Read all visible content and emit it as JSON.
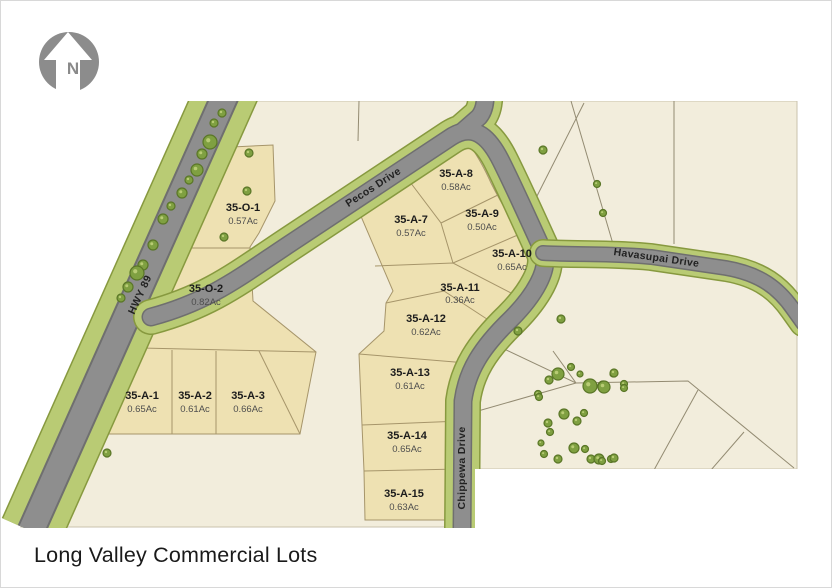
{
  "title": "Long Valley Commercial Lots",
  "north": {
    "label": "N"
  },
  "roads": [
    {
      "name": "HWY 89"
    },
    {
      "name": "Pecos Drive"
    },
    {
      "name": "Havasupai Drive"
    },
    {
      "name": "Chippewa Drive"
    }
  ],
  "lots": [
    {
      "id": "35-O-1",
      "acreage": "0.57Ac"
    },
    {
      "id": "35-O-2",
      "acreage": "0.82Ac"
    },
    {
      "id": "35-A-1",
      "acreage": "0.65Ac"
    },
    {
      "id": "35-A-2",
      "acreage": "0.61Ac"
    },
    {
      "id": "35-A-3",
      "acreage": "0.66Ac"
    },
    {
      "id": "35-A-7",
      "acreage": "0.57Ac"
    },
    {
      "id": "35-A-8",
      "acreage": "0.58Ac"
    },
    {
      "id": "35-A-9",
      "acreage": "0.50Ac"
    },
    {
      "id": "35-A-10",
      "acreage": "0.65Ac"
    },
    {
      "id": "35-A-11",
      "acreage": "0.36Ac"
    },
    {
      "id": "35-A-12",
      "acreage": "0.62Ac"
    },
    {
      "id": "35-A-13",
      "acreage": "0.61Ac"
    },
    {
      "id": "35-A-14",
      "acreage": "0.65Ac"
    },
    {
      "id": "35-A-15",
      "acreage": "0.63Ac"
    }
  ],
  "colors": {
    "land": "#f2eddc",
    "lot_fill": "#eee1b2",
    "lot_line": "#a6956a",
    "parcel_line": "#938b72",
    "road_gray": "#8e8e8e",
    "road_edge": "#6f6f6f",
    "verge_green": "#b9cb74",
    "verge_edge": "#87993f",
    "tree_fill": "#7fa041",
    "tree_stroke": "#5a7627",
    "tree_dot": "#b8cc74",
    "north_gray": "#8c8c8c"
  },
  "map_data": {
    "trees": [
      [
        221,
        112,
        4
      ],
      [
        213,
        122,
        4
      ],
      [
        209,
        141,
        7
      ],
      [
        201,
        153,
        5
      ],
      [
        196,
        169,
        6
      ],
      [
        188,
        179,
        4
      ],
      [
        181,
        192,
        5
      ],
      [
        170,
        205,
        4
      ],
      [
        162,
        218,
        5
      ],
      [
        152,
        244,
        5
      ],
      [
        142,
        264,
        5
      ],
      [
        136,
        272,
        7
      ],
      [
        127,
        286,
        5
      ],
      [
        120,
        297,
        4
      ],
      [
        248,
        152,
        4
      ],
      [
        246,
        190,
        4
      ],
      [
        223,
        236,
        4
      ],
      [
        106,
        452,
        4
      ],
      [
        542,
        149,
        4
      ],
      [
        596,
        183,
        3.5
      ],
      [
        602,
        212,
        3.5
      ],
      [
        560,
        318,
        4
      ],
      [
        517,
        330,
        4
      ],
      [
        557,
        373,
        6
      ],
      [
        548,
        379,
        4
      ],
      [
        570,
        366,
        3.5
      ],
      [
        579,
        373,
        3
      ],
      [
        589,
        385,
        7
      ],
      [
        602,
        385,
        5
      ],
      [
        612,
        373,
        3
      ],
      [
        623,
        383,
        3.5
      ],
      [
        537,
        393,
        3.5
      ],
      [
        563,
        413,
        5
      ],
      [
        576,
        420,
        4
      ],
      [
        583,
        412,
        3.5
      ],
      [
        547,
        422,
        4
      ],
      [
        549,
        431,
        3.5
      ],
      [
        540,
        442,
        3
      ],
      [
        543,
        453,
        3.5
      ],
      [
        557,
        458,
        4
      ],
      [
        573,
        447,
        5
      ],
      [
        584,
        448,
        3.5
      ],
      [
        590,
        458,
        4
      ],
      [
        598,
        458,
        5
      ],
      [
        610,
        458,
        3.5
      ],
      [
        613,
        372,
        4
      ],
      [
        603,
        386,
        6
      ],
      [
        623,
        387,
        3.5
      ],
      [
        613,
        457,
        4
      ],
      [
        601,
        460,
        3.5
      ],
      [
        538,
        396,
        3.5
      ]
    ]
  }
}
